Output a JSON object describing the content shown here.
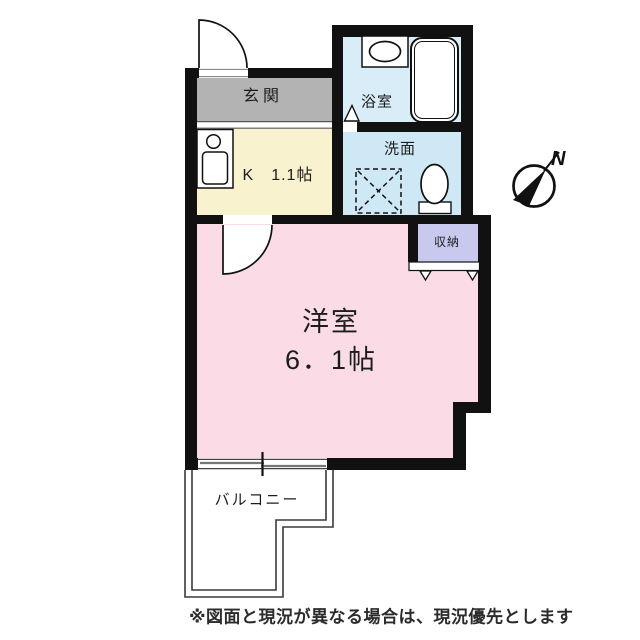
{
  "floorplan": {
    "rooms": {
      "genkan": {
        "label": "玄関",
        "color": "#b3b3b3"
      },
      "kitchen": {
        "label": "K　1.1帖",
        "color": "#f8f2cf"
      },
      "bathroom": {
        "label": "浴室",
        "color": "#d8edf8"
      },
      "washroom": {
        "label": "洗面",
        "color": "#cfe8f6"
      },
      "storage": {
        "label": "収納",
        "color": "#c9c9ef"
      },
      "main_room": {
        "label_line1": "洋室",
        "label_line2": "6．1帖",
        "color": "#fadbe6"
      },
      "balcony": {
        "label": "バルコニー"
      }
    },
    "compass": {
      "label": "N"
    },
    "disclaimer": "※図面と現況が異なる場合は、現況優先とします",
    "wall_color": "#111111",
    "outline_color": "#3a3a3a"
  }
}
